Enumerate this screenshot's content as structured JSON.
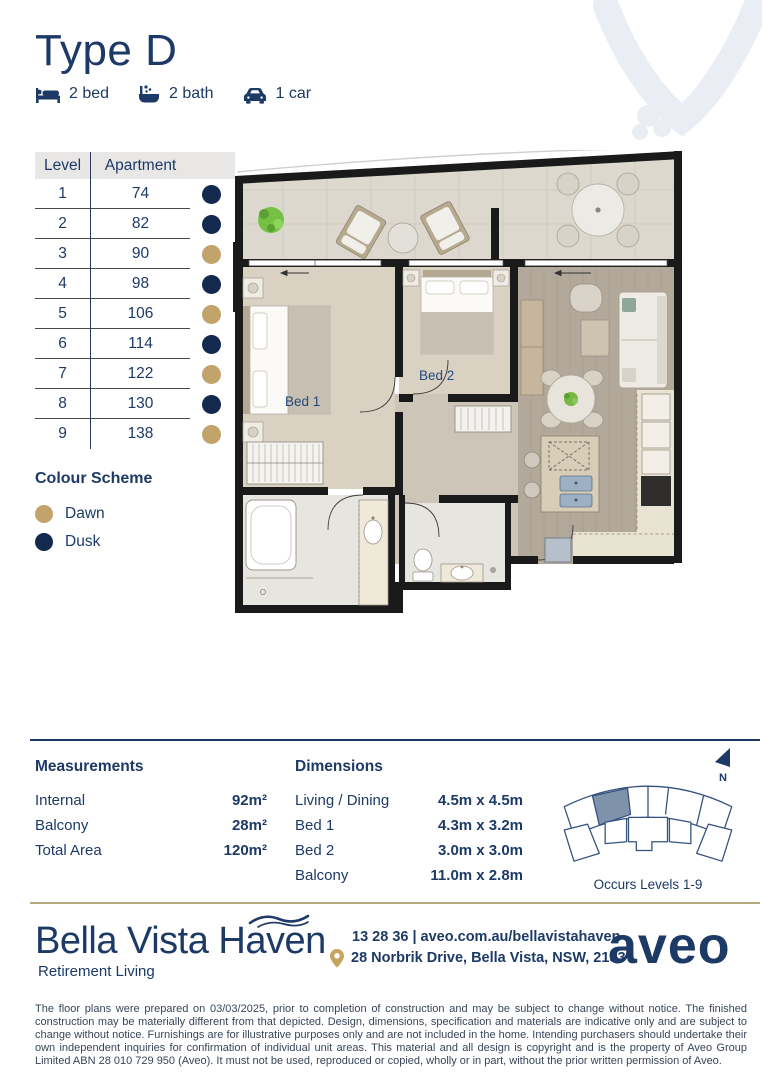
{
  "header": {
    "title": "Type D",
    "features": [
      {
        "icon": "bed-icon",
        "label": "2 bed"
      },
      {
        "icon": "bath-icon",
        "label": "2 bath"
      },
      {
        "icon": "car-icon",
        "label": "1 car"
      }
    ]
  },
  "apartment_table": {
    "level_header": "Level",
    "apartment_header": "Apartment",
    "rows": [
      {
        "level": "1",
        "apartment": "74",
        "scheme": "dusk"
      },
      {
        "level": "2",
        "apartment": "82",
        "scheme": "dusk"
      },
      {
        "level": "3",
        "apartment": "90",
        "scheme": "dawn"
      },
      {
        "level": "4",
        "apartment": "98",
        "scheme": "dusk"
      },
      {
        "level": "5",
        "apartment": "106",
        "scheme": "dawn"
      },
      {
        "level": "6",
        "apartment": "114",
        "scheme": "dusk"
      },
      {
        "level": "7",
        "apartment": "122",
        "scheme": "dawn"
      },
      {
        "level": "8",
        "apartment": "130",
        "scheme": "dusk"
      },
      {
        "level": "9",
        "apartment": "138",
        "scheme": "dawn"
      }
    ]
  },
  "colour_scheme": {
    "title": "Colour Scheme",
    "items": [
      {
        "label": "Dawn",
        "scheme": "dawn"
      },
      {
        "label": "Dusk",
        "scheme": "dusk"
      }
    ]
  },
  "floor_plan": {
    "bed1_label": "Bed 1",
    "bed2_label": "Bed 2"
  },
  "measurements": {
    "title": "Measurements",
    "rows": [
      {
        "label": "Internal",
        "value": "92m²"
      },
      {
        "label": "Balcony",
        "value": "28m²"
      },
      {
        "label": "Total Area",
        "value": "120m²"
      }
    ]
  },
  "dimensions": {
    "title": "Dimensions",
    "rows": [
      {
        "label": "Living / Dining",
        "value": "4.5m x 4.5m"
      },
      {
        "label": "Bed 1",
        "value": "4.3m x 3.2m"
      },
      {
        "label": "Bed 2",
        "value": "3.0m x 3.0m"
      },
      {
        "label": "Balcony",
        "value": "11.0m x 2.8m"
      }
    ]
  },
  "key_plan": {
    "caption": "Occurs Levels 1-9",
    "north_label": "N"
  },
  "footer": {
    "brand": "Bella Vista Haven",
    "tagline": "Retirement Living",
    "phone_and_web": "13 28 36 | aveo.com.au/bellavistahaven",
    "address": "28 Norbrik Drive, Bella Vista, NSW, 2153",
    "logo_text": "aveo"
  },
  "disclaimer": "The floor plans were prepared on 03/03/2025, prior to completion of construction and may be subject to change without notice. The finished construction may be materially different from that depicted. Design, dimensions, specification and materials are indicative only and are subject to change without notice. Furnishings are for illustrative purposes only and are not included in the home. Intending purchasers should undertake their own independent inquiries for confirmation of individual unit areas. This material and all design is copyright and is the property of Aveo Group Limited ABN 28 010 729 950 (Aveo). It must not be used, reproduced or copied, wholly or in part, without the prior written permission of Aveo.",
  "colors": {
    "navy": "#1d3a66",
    "dusk": "#13294e",
    "dawn": "#c2a36b",
    "gold_line": "#b3a77d",
    "keyplan_highlight": "#7e93aa"
  }
}
